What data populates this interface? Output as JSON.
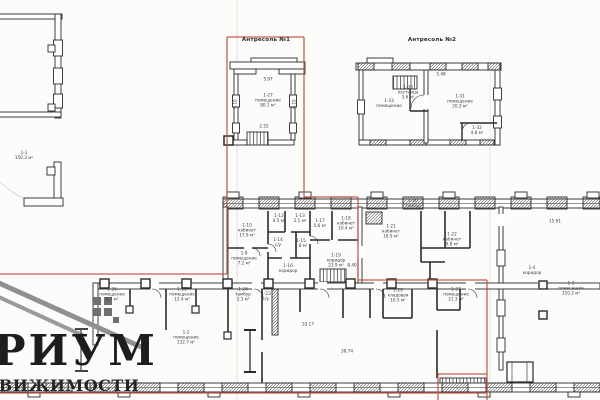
{
  "colors": {
    "paper": "#fcfcfa",
    "ink": "#2a2a2a",
    "red_outline": "#c14b42",
    "logo_gray": "#909090"
  },
  "titles": {
    "mezzanine1": "Антресоль №1",
    "mezzanine2": "Антресоль №2"
  },
  "logo": {
    "name": "РИУМ",
    "subtitle": "ДВИЖИМОСТИ"
  },
  "annotations": [
    {
      "x": 268,
      "y": 80,
      "t": "5.97"
    },
    {
      "x": 268,
      "y": 101,
      "t": "1-27\nпомещение\n80.1 м²"
    },
    {
      "x": 264,
      "y": 127,
      "t": "2.52"
    },
    {
      "x": 236,
      "y": 104,
      "t": "6.10",
      "r": -90
    },
    {
      "x": 295,
      "y": 104,
      "t": "6.10",
      "r": -90
    },
    {
      "x": 408,
      "y": 93,
      "t": "1-30\nлестница\n3.6 м²"
    },
    {
      "x": 389,
      "y": 104,
      "t": "1-33\nпомещение"
    },
    {
      "x": 460,
      "y": 102,
      "t": "1-31\nпомещение\n20.3 м²"
    },
    {
      "x": 477,
      "y": 131,
      "t": "1-32\n4.8 м²"
    },
    {
      "x": 441,
      "y": 75,
      "t": "5.48"
    },
    {
      "x": 24,
      "y": 156,
      "t": "1-1\n150.3 м²"
    },
    {
      "x": 247,
      "y": 231,
      "t": "1-10\nкабинет\n17.9 м²"
    },
    {
      "x": 244,
      "y": 259,
      "t": "1-9\nпомещение\n7.2 м²"
    },
    {
      "x": 279,
      "y": 219,
      "t": "1-12\n4.5 м²"
    },
    {
      "x": 300,
      "y": 219,
      "t": "1-13\n2.1 м²"
    },
    {
      "x": 278,
      "y": 243,
      "t": "1-14\nс/у"
    },
    {
      "x": 301,
      "y": 244,
      "t": "1-15\n2.8 м²"
    },
    {
      "x": 288,
      "y": 269,
      "t": "1-16\nкоридор"
    },
    {
      "x": 320,
      "y": 224,
      "t": "1-17\n5.6 м²"
    },
    {
      "x": 346,
      "y": 224,
      "t": "1-18\nкабинет\n10.4 м²"
    },
    {
      "x": 336,
      "y": 261,
      "t": "1-19\nкоридор\n23.9 м²"
    },
    {
      "x": 391,
      "y": 232,
      "t": "1-21\nкабинет\n18.9 м²"
    },
    {
      "x": 413,
      "y": 204,
      "t": "1-20\nтамбур"
    },
    {
      "x": 452,
      "y": 240,
      "t": "1-22\nкабинет\n9.8 м²"
    },
    {
      "x": 532,
      "y": 271,
      "t": "1-4\nкоридор"
    },
    {
      "x": 571,
      "y": 289,
      "t": "1-3\nпомещение\n310.2 м²"
    },
    {
      "x": 555,
      "y": 222,
      "t": "15.91"
    },
    {
      "x": 112,
      "y": 295,
      "t": "1-26\nпомещение\n8.7 м²"
    },
    {
      "x": 182,
      "y": 295,
      "t": "1-25\nпомещение\n12.4 м²"
    },
    {
      "x": 243,
      "y": 295,
      "t": "1-24\nтамбур\n3.3 м²"
    },
    {
      "x": 266,
      "y": 297,
      "t": "1-23\nс/у"
    },
    {
      "x": 186,
      "y": 338,
      "t": "1-2\nпомещение\n132.7 м²"
    },
    {
      "x": 308,
      "y": 325,
      "t": "33.17"
    },
    {
      "x": 347,
      "y": 352,
      "t": "38.74"
    },
    {
      "x": 398,
      "y": 296,
      "t": "1-29\nкладовая\n10.5 м²"
    },
    {
      "x": 456,
      "y": 295,
      "t": "1-27\nпомещение\n21.3 м²"
    },
    {
      "x": 352,
      "y": 266,
      "t": "8.40"
    }
  ]
}
